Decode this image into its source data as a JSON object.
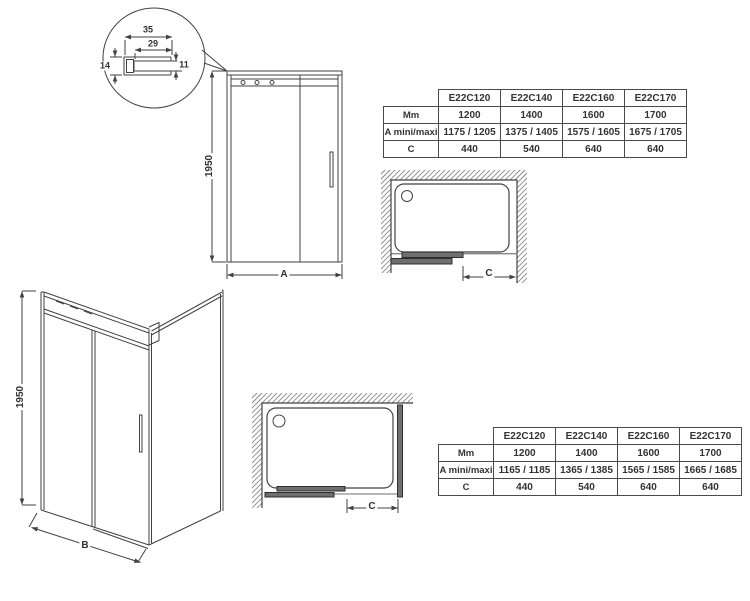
{
  "colors": {
    "line": "#424242",
    "text": "#333333",
    "bar_fill": "#6f6f6f",
    "bar_outline": "#2f2f2f",
    "hatch": "#8a8a8a",
    "background": "#ffffff"
  },
  "detail_inset": {
    "dim_overall_width": "35",
    "dim_inner_width": "29",
    "dim_left_height": "14",
    "dim_right_height": "11"
  },
  "front_view": {
    "height_dim": "1950",
    "width_dim": "A"
  },
  "perspective_view": {
    "height_dim": "1950",
    "width_dim": "B"
  },
  "plan_view_top": {
    "opening_dim": "C"
  },
  "plan_view_bottom": {
    "opening_dim": "C"
  },
  "table_top": {
    "col_headers": [
      "E22C120",
      "E22C140",
      "E22C160",
      "E22C170"
    ],
    "rows": [
      {
        "label": "Mm",
        "values": [
          "1200",
          "1400",
          "1600",
          "1700"
        ]
      },
      {
        "label": "A mini/maxi",
        "values": [
          "1175 / 1205",
          "1375 / 1405",
          "1575 / 1605",
          "1675 / 1705"
        ]
      },
      {
        "label": "C",
        "values": [
          "440",
          "540",
          "640",
          "640"
        ]
      }
    ]
  },
  "table_bottom": {
    "col_headers": [
      "E22C120",
      "E22C140",
      "E22C160",
      "E22C170"
    ],
    "rows": [
      {
        "label": "Mm",
        "values": [
          "1200",
          "1400",
          "1600",
          "1700"
        ]
      },
      {
        "label": "A mini/maxi",
        "values": [
          "1165 / 1185",
          "1365 / 1385",
          "1565 / 1585",
          "1665 / 1685"
        ]
      },
      {
        "label": "C",
        "values": [
          "440",
          "540",
          "640",
          "640"
        ]
      }
    ]
  }
}
